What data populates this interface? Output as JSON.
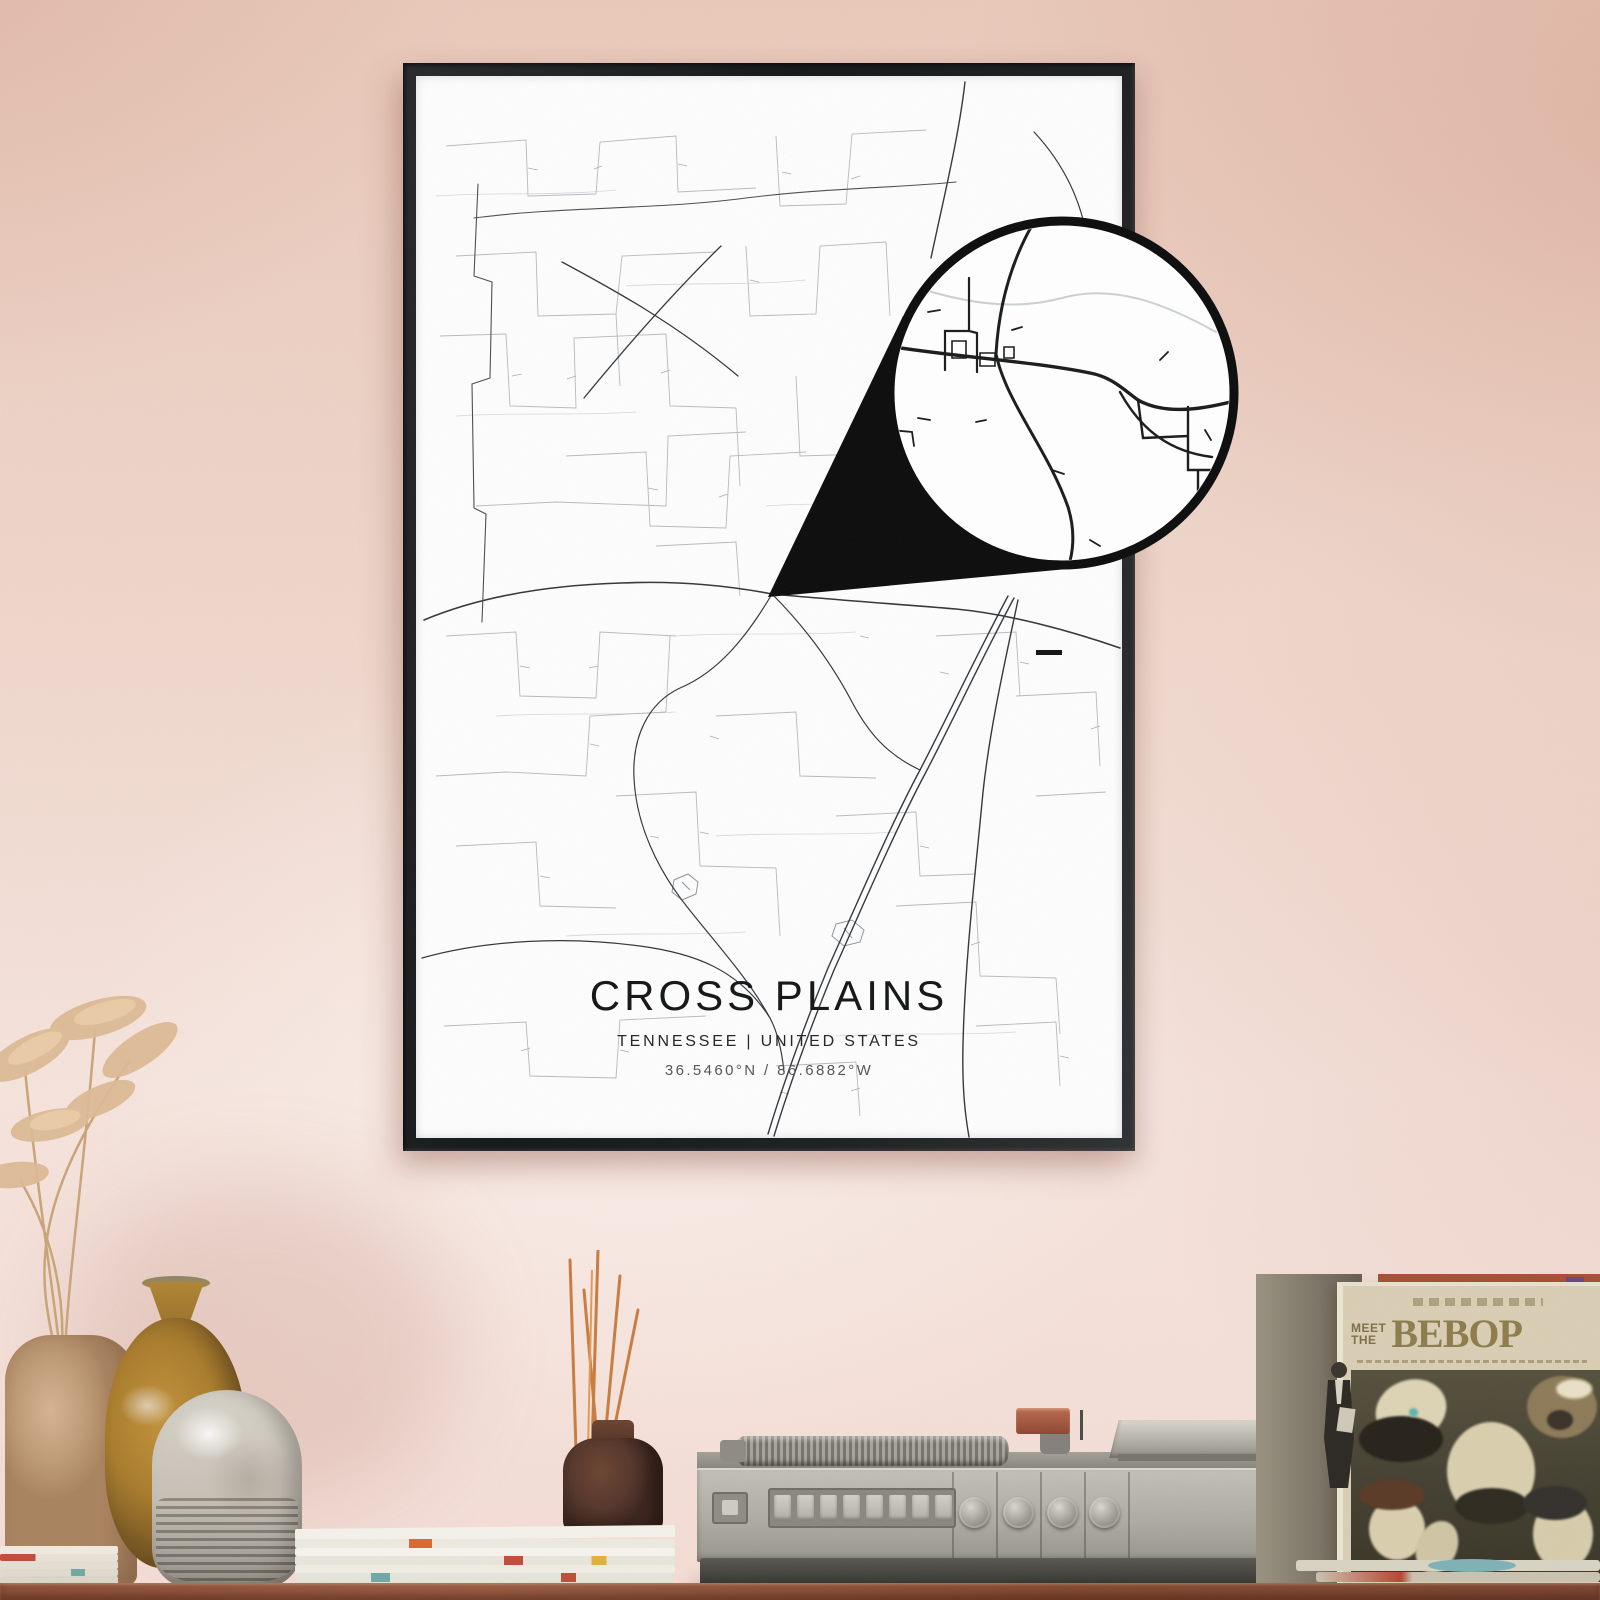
{
  "poster": {
    "title": "CROSS PLAINS",
    "subtitle": "TENNESSEE | UNITED STATES",
    "coordinates": "36.5460°N / 86.6882°W"
  },
  "album": {
    "meet": "MEET",
    "the": "THE",
    "title": "BEBOP"
  },
  "scene_objects": [
    "framed-map-poster",
    "map-zoom-callout",
    "pampas-grass",
    "tan-vase",
    "ochre-vase",
    "stoneware-vase",
    "magazine-stack",
    "reed-diffuser-bottle",
    "record-player",
    "suit-figurine",
    "record-sleeve",
    "vinyl-records",
    "wood-sideboard"
  ],
  "colors": {
    "wall": "#eed4c9",
    "frame": "#1b1d1f",
    "poster": "#fdfdfd",
    "road_major": "#33373b",
    "road_minor": "#b6babe",
    "wood": "#8a5138",
    "radio_body": "#b5b2a9",
    "radio_base": "#44433e",
    "album_cream": "#d9ceb4",
    "album_photo": "#4c4635",
    "album_text": "#8d7c4c",
    "incense_stick": "#c97c3f",
    "bottle_brown": "#5c3a2a",
    "vase_tan": "#c4a27f",
    "vase_ochre": "#b08030",
    "vase_cream": "#cdc7bc",
    "record_red": "#a94f36",
    "record_teal": "#7fb2b5"
  }
}
